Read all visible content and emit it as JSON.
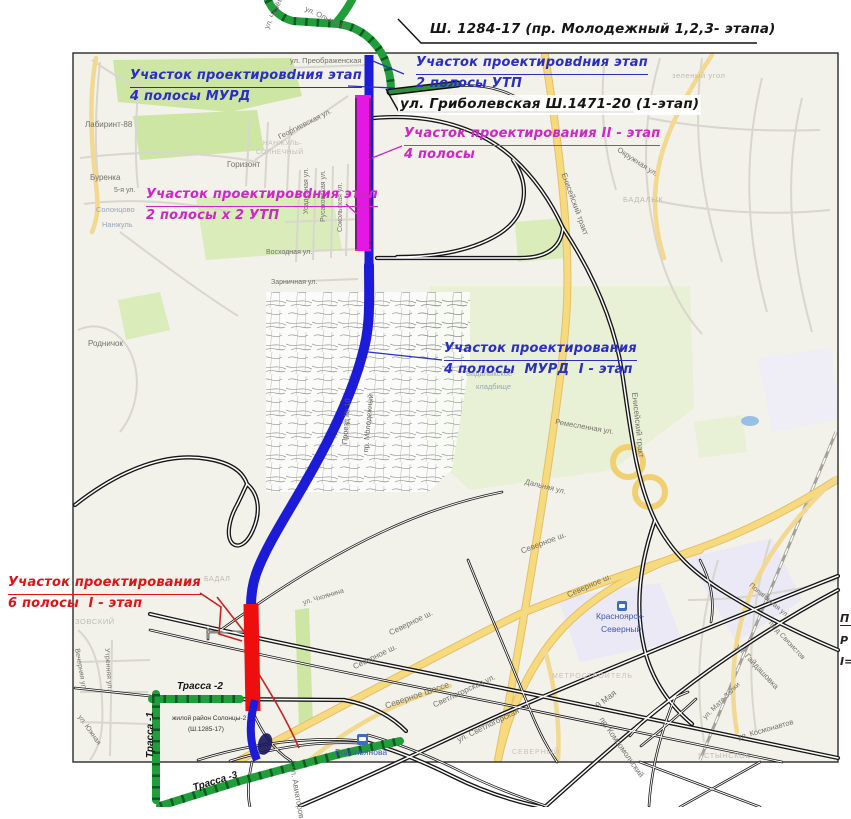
{
  "colors": {
    "route_stage1_blue": "#1c1cd8",
    "route_stage2_magenta": "#e318e3",
    "route_6lanes_red": "#ef0e0e",
    "route_trassa_green": "#1f9e3a",
    "callout_blue": "#2a2ec4",
    "callout_magenta": "#d025c8",
    "callout_red": "#e01414",
    "map_road_yellow": "#f7d97e",
    "park_green": "#cde6a4",
    "map_background": "#f2f1ea"
  },
  "legend": {
    "l1": "П",
    "l2": "Р",
    "l3": "I="
  },
  "callouts": [
    {
      "id": "molodezhny",
      "cls": "blk",
      "x": 430,
      "y": 20,
      "ul": false,
      "lines": [
        "Ш. 1284-17 (пр. Молодежный 1,2,3- этапа)"
      ]
    },
    {
      "id": "utp-north",
      "cls": "blu",
      "x": 416,
      "y": 54,
      "ul": true,
      "lines": [
        "Участок проектировdния этап",
        "2 полосы УТП"
      ]
    },
    {
      "id": "gribolevskaya",
      "cls": "blk bg",
      "x": 398,
      "y": 95,
      "ul": false,
      "lines": [
        "ул. Гриболевская Ш.1471-20 (1-этап)"
      ]
    },
    {
      "id": "murd-north",
      "cls": "blu",
      "x": 130,
      "y": 67,
      "ul": true,
      "lines": [
        "Участок проектировdния этап",
        "4 полосы МУРД"
      ]
    },
    {
      "id": "utp-west",
      "cls": "pnk",
      "x": 146,
      "y": 186,
      "ul": true,
      "lines": [
        "Участок проектировdния этап",
        "2 полосы х 2 УТП"
      ]
    },
    {
      "id": "stage2",
      "cls": "pnk",
      "x": 404,
      "y": 125,
      "ul": true,
      "lines": [
        "Участок проектирования II - этап",
        "4 полосы"
      ]
    },
    {
      "id": "stage1-murd",
      "cls": "blu",
      "x": 444,
      "y": 340,
      "ul": true,
      "lines": [
        "Участок проектирования",
        "4 полосы  МУРД  I - этап"
      ]
    },
    {
      "id": "stage1-6lanes",
      "cls": "red",
      "x": 8,
      "y": 574,
      "ul": true,
      "lines": [
        "Участок проектирования",
        "6 полосы  I - этап"
      ]
    }
  ],
  "map_labels": [
    {
      "t": "Лабиринт-88",
      "x": 85,
      "y": 121,
      "r": 0,
      "s": 8,
      "cls": "st"
    },
    {
      "t": "Буренка",
      "x": 90,
      "y": 174,
      "r": 0,
      "s": 8,
      "cls": "st"
    },
    {
      "t": "Горизонт",
      "x": 227,
      "y": 161,
      "r": 0,
      "s": 8,
      "cls": "st"
    },
    {
      "t": "НАНЖУЛЬ-",
      "x": 263,
      "y": 141,
      "r": 0,
      "s": 6.5,
      "cls": "ft"
    },
    {
      "t": "СОЛНЕЧНЫЙ",
      "x": 256,
      "y": 150,
      "r": 0,
      "s": 6.5,
      "cls": "ft"
    },
    {
      "t": "Георгиевская ул.",
      "x": 277,
      "y": 134,
      "r": -27,
      "s": 7.5,
      "cls": "st"
    },
    {
      "t": "ул. Преображенская",
      "x": 290,
      "y": 57,
      "r": 0,
      "s": 7.5,
      "cls": "st"
    },
    {
      "t": "5-я ул.",
      "x": 114,
      "y": 187,
      "r": 0,
      "s": 7,
      "cls": "st"
    },
    {
      "t": "Солонцово",
      "x": 96,
      "y": 206,
      "r": 0,
      "s": 7.5,
      "cls": "cem"
    },
    {
      "t": "Нанжуль",
      "x": 102,
      "y": 221,
      "r": 0,
      "s": 7.5,
      "cls": "cem"
    },
    {
      "t": "ул. Черёмуховая",
      "x": 263,
      "y": 27,
      "r": -65,
      "s": 7.5,
      "cls": "st"
    },
    {
      "t": "ул. Ольховая",
      "x": 307,
      "y": 5,
      "r": 25,
      "s": 7.5,
      "cls": "st"
    },
    {
      "t": "зеленый угол",
      "x": 672,
      "y": 72,
      "r": 0,
      "s": 7.5,
      "cls": "ft"
    },
    {
      "t": "Окружная ул.",
      "x": 620,
      "y": 146,
      "r": 33,
      "s": 7.5,
      "cls": "st"
    },
    {
      "t": "БАДАЛЫК",
      "x": 623,
      "y": 196,
      "r": 0,
      "s": 7.5,
      "cls": "ft"
    },
    {
      "t": "Енисейский тракт",
      "x": 567,
      "y": 172,
      "r": 70,
      "s": 8,
      "cls": "st"
    },
    {
      "t": "Енисейский тракт",
      "x": 638,
      "y": 392,
      "r": 84,
      "s": 8,
      "cls": "st"
    },
    {
      "t": "Ремесленная ул.",
      "x": 556,
      "y": 418,
      "r": 10,
      "s": 7.5,
      "cls": "st"
    },
    {
      "t": "Дальняя ул.",
      "x": 526,
      "y": 478,
      "r": 14,
      "s": 7.5,
      "cls": "st"
    },
    {
      "t": "Бадалыкское",
      "x": 466,
      "y": 370,
      "r": 0,
      "s": 7.5,
      "cls": "cem"
    },
    {
      "t": "кладбище",
      "x": 476,
      "y": 383,
      "r": 0,
      "s": 7.5,
      "cls": "cem"
    },
    {
      "t": "Восходная ул.",
      "x": 266,
      "y": 249,
      "r": 0,
      "s": 7,
      "cls": "st"
    },
    {
      "t": "Зарничная ул.",
      "x": 271,
      "y": 279,
      "r": 0,
      "s": 7,
      "cls": "st"
    },
    {
      "t": "Сокольская ул.",
      "x": 337,
      "y": 232,
      "r": -90,
      "s": 7,
      "cls": "st"
    },
    {
      "t": "Русаковская ул.",
      "x": 320,
      "y": 222,
      "r": -90,
      "s": 7,
      "cls": "st"
    },
    {
      "t": "Усадебная ул.",
      "x": 303,
      "y": 214,
      "r": -90,
      "s": 7,
      "cls": "st"
    },
    {
      "t": "пр. Молодежный",
      "x": 362,
      "y": 452,
      "r": -85,
      "s": 7.5,
      "cls": "std"
    },
    {
      "t": "Проезд № 10",
      "x": 341,
      "y": 444,
      "r": -86,
      "s": 7.5,
      "cls": "std"
    },
    {
      "t": "ул. Чхоянина",
      "x": 302,
      "y": 600,
      "r": -17,
      "s": 7,
      "cls": "st"
    },
    {
      "t": "Северное ш.",
      "x": 520,
      "y": 548,
      "r": -21,
      "s": 8,
      "cls": "st"
    },
    {
      "t": "Северное ш.",
      "x": 566,
      "y": 592,
      "r": -24,
      "s": 8,
      "cls": "st"
    },
    {
      "t": "Северное ш.",
      "x": 388,
      "y": 630,
      "r": -26,
      "s": 8,
      "cls": "st"
    },
    {
      "t": "Северное ш.",
      "x": 352,
      "y": 664,
      "r": -26,
      "s": 8,
      "cls": "st"
    },
    {
      "t": "Северное Шоссе",
      "x": 384,
      "y": 702,
      "r": -19,
      "s": 8.5,
      "cls": "st"
    },
    {
      "t": "Светлогорская ул.",
      "x": 432,
      "y": 702,
      "r": -25,
      "s": 8,
      "cls": "st"
    },
    {
      "t": "ул. Светлогорская",
      "x": 456,
      "y": 737,
      "r": -26,
      "s": 8,
      "cls": "st"
    },
    {
      "t": "ул. Авиаторов",
      "x": 296,
      "y": 766,
      "r": 80,
      "s": 8,
      "cls": "st"
    },
    {
      "t": "Водопьянова",
      "x": 335,
      "y": 748,
      "r": 0,
      "s": 8.5,
      "cls": "bl"
    },
    {
      "t": "Красноярск-",
      "x": 596,
      "y": 612,
      "r": 0,
      "s": 8.5,
      "cls": "bl"
    },
    {
      "t": "Северный",
      "x": 601,
      "y": 625,
      "r": 0,
      "s": 8.5,
      "cls": "bl"
    },
    {
      "t": "МЕТРОСТРОИТЕЛЬ",
      "x": 552,
      "y": 673,
      "r": 0,
      "s": 7,
      "cls": "wm"
    },
    {
      "t": "СЕВЕРНЫЙ",
      "x": 512,
      "y": 749,
      "r": 0,
      "s": 7,
      "cls": "wm"
    },
    {
      "t": "9 Мая",
      "x": 594,
      "y": 703,
      "r": -38,
      "s": 8.5,
      "cls": "st"
    },
    {
      "t": "пр. Комсомольский",
      "x": 604,
      "y": 716,
      "r": 55,
      "s": 8,
      "cls": "st"
    },
    {
      "t": "ул. Гайдашовка",
      "x": 740,
      "y": 643,
      "r": 47,
      "s": 8,
      "cls": "st"
    },
    {
      "t": "пр-д Связистов",
      "x": 772,
      "y": 620,
      "r": 47,
      "s": 7,
      "cls": "st"
    },
    {
      "t": "Полигонная ул.",
      "x": 752,
      "y": 582,
      "r": 40,
      "s": 7,
      "cls": "st"
    },
    {
      "t": "ул. Мате Залки",
      "x": 702,
      "y": 716,
      "r": -45,
      "s": 7,
      "cls": "st"
    },
    {
      "t": "ул. Космонавтов",
      "x": 737,
      "y": 734,
      "r": -16,
      "s": 7.5,
      "cls": "st"
    },
    {
      "t": "ЯСТЫНСКОЕ",
      "x": 698,
      "y": 752,
      "r": 0,
      "s": 7.5,
      "cls": "ft"
    },
    {
      "t": "Вечерняя ул.",
      "x": 80,
      "y": 648,
      "r": 80,
      "s": 7,
      "cls": "st"
    },
    {
      "t": "Утренняя ул.",
      "x": 110,
      "y": 648,
      "r": 86,
      "s": 7,
      "cls": "st"
    },
    {
      "t": "ул. Южная",
      "x": 82,
      "y": 714,
      "r": 55,
      "s": 7,
      "cls": "st"
    },
    {
      "t": "ЗОВСКИЙ",
      "x": 75,
      "y": 618,
      "r": 0,
      "s": 7.5,
      "cls": "ft"
    },
    {
      "t": "Родничок",
      "x": 88,
      "y": 340,
      "r": 0,
      "s": 8,
      "cls": "st"
    },
    {
      "t": "БАДАЛ",
      "x": 204,
      "y": 576,
      "r": 0,
      "s": 7,
      "cls": "ft"
    },
    {
      "t": "Трасса -2",
      "x": 177,
      "y": 682,
      "r": 0,
      "s": 10,
      "cls": "tr"
    },
    {
      "t": "Трасса -1",
      "x": 146,
      "y": 758,
      "r": -90,
      "s": 10,
      "cls": "tr"
    },
    {
      "t": "Трасса -3",
      "x": 192,
      "y": 784,
      "r": -17,
      "s": 10,
      "cls": "tr"
    },
    {
      "t": "жилой район Солонцы-2",
      "x": 172,
      "y": 716,
      "r": 0,
      "s": 6.5,
      "cls": "note"
    },
    {
      "t": "(Ш.1285-17)",
      "x": 188,
      "y": 727,
      "r": 0,
      "s": 6.5,
      "cls": "note"
    }
  ]
}
